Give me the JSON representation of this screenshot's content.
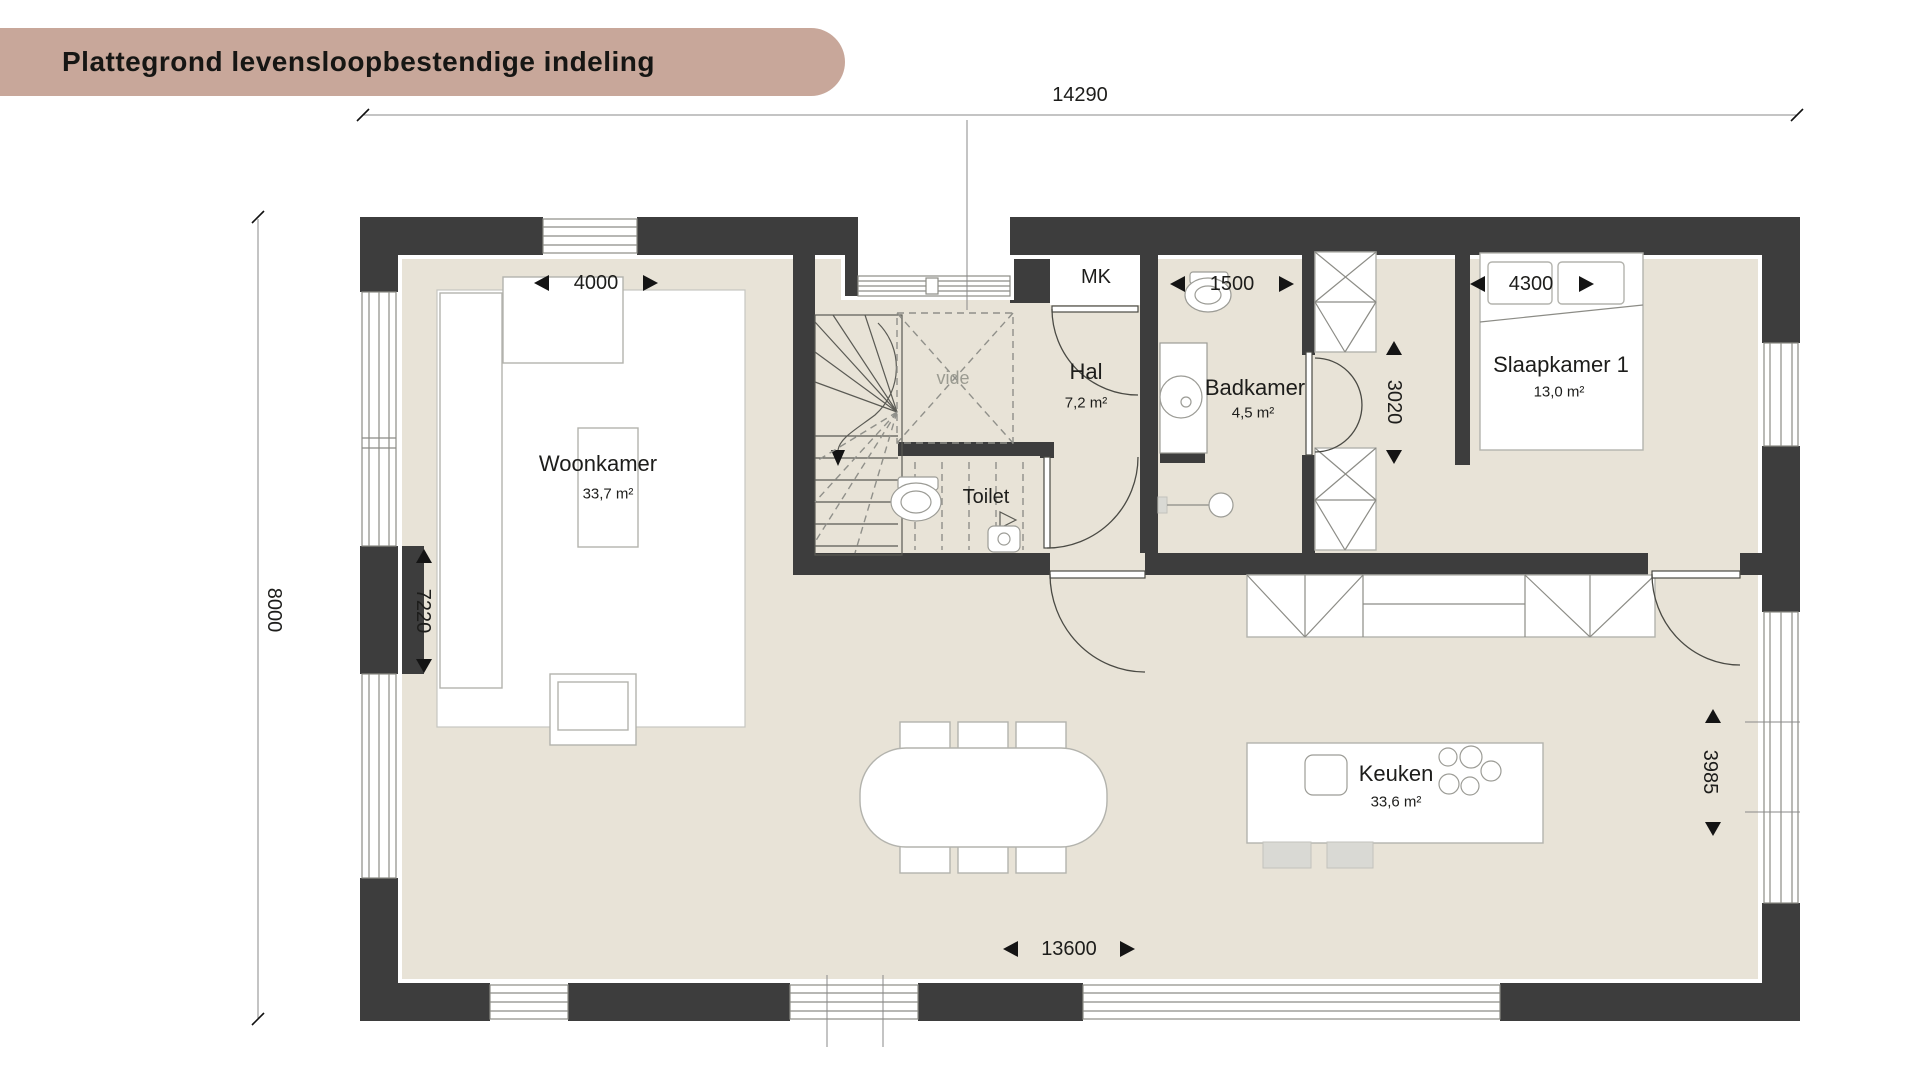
{
  "title": "Plattegrond levensloopbestendige indeling",
  "rooms": {
    "woonkamer": {
      "name": "Woonkamer",
      "area": "33,7 m²"
    },
    "hal": {
      "name": "Hal",
      "area": "7,2 m²"
    },
    "toilet": {
      "name": "Toilet"
    },
    "mk": {
      "name": "MK"
    },
    "badkamer": {
      "name": "Badkamer",
      "area": "4,5 m²"
    },
    "slaapkamer1": {
      "name": "Slaapkamer 1",
      "area": "13,0 m²"
    },
    "keuken": {
      "name": "Keuken",
      "area": "33,6 m²"
    },
    "vide": {
      "name": "vide"
    }
  },
  "dimensions": {
    "total_width": "14290",
    "total_depth": "8000",
    "inner_width": "13600",
    "woonkamer_window": "4000",
    "woonkamer_depth": "7220",
    "badkamer_width": "1500",
    "corridor_depth": "3020",
    "slaapkamer_width": "4300",
    "keuken_window": "3985"
  },
  "colors": {
    "banner": "#c8a79a",
    "wall": "#3d3d3d",
    "floor": "#e8e3d7",
    "text": "#1d1d1b"
  }
}
